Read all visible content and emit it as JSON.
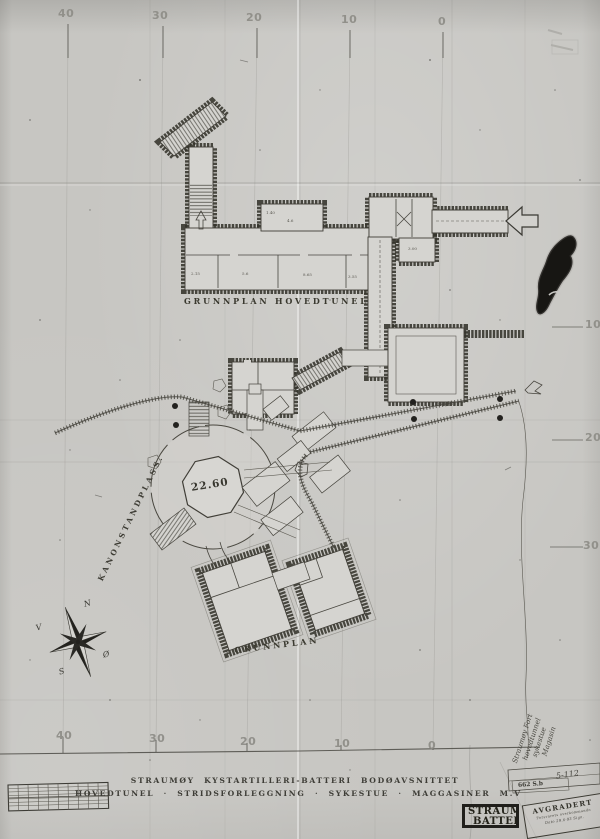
{
  "labels": {
    "main_plan": "GRUNNPLAN HOVEDTUNEL",
    "magazine_plan": "GRUNNPLAN",
    "gun_platform": "KANONSTANDPLASS.",
    "platform_elevation": "22.60"
  },
  "title": {
    "line1": "STRAUMØY KYSTARTILLERI-BATTERI BODØAVSNITTET",
    "line2": "HOVEDTUNEL · STRIDSFORLEGGNING · SYKESTUE · MAGGASINER M.V"
  },
  "ruler": {
    "top": [
      "40",
      "30",
      "20",
      "10",
      "0"
    ],
    "bottom": [
      "40",
      "30",
      "20",
      "10",
      "0"
    ],
    "right": [
      "10",
      "20",
      "30"
    ]
  },
  "compass": {
    "north": "N",
    "south": "S",
    "west": "V",
    "east": "Ø"
  },
  "dimensions": {
    "d1": "2.15",
    "d2": "5.6",
    "d3": "8.65",
    "d4": "3.55",
    "d5": "3.00",
    "d6": "4.6",
    "d7": "1.40"
  },
  "annotations": {
    "note_lines": [
      "Straumøy Fort",
      "hovedtunnel",
      "sykestue",
      "Magasin"
    ],
    "ref_number": "5-112",
    "file_code": "662 S.b",
    "declassified_stamp": {
      "title": "AVGRADERT",
      "authority": "Forsvarets overkommando",
      "date_line": "Dato 29.6-93 Sign."
    },
    "battery_stamp": {
      "line1": "STRAUMØY",
      "line2": "BATTERI"
    }
  },
  "colors": {
    "paper": "#c7c6c2",
    "ink": "#34332b"
  }
}
